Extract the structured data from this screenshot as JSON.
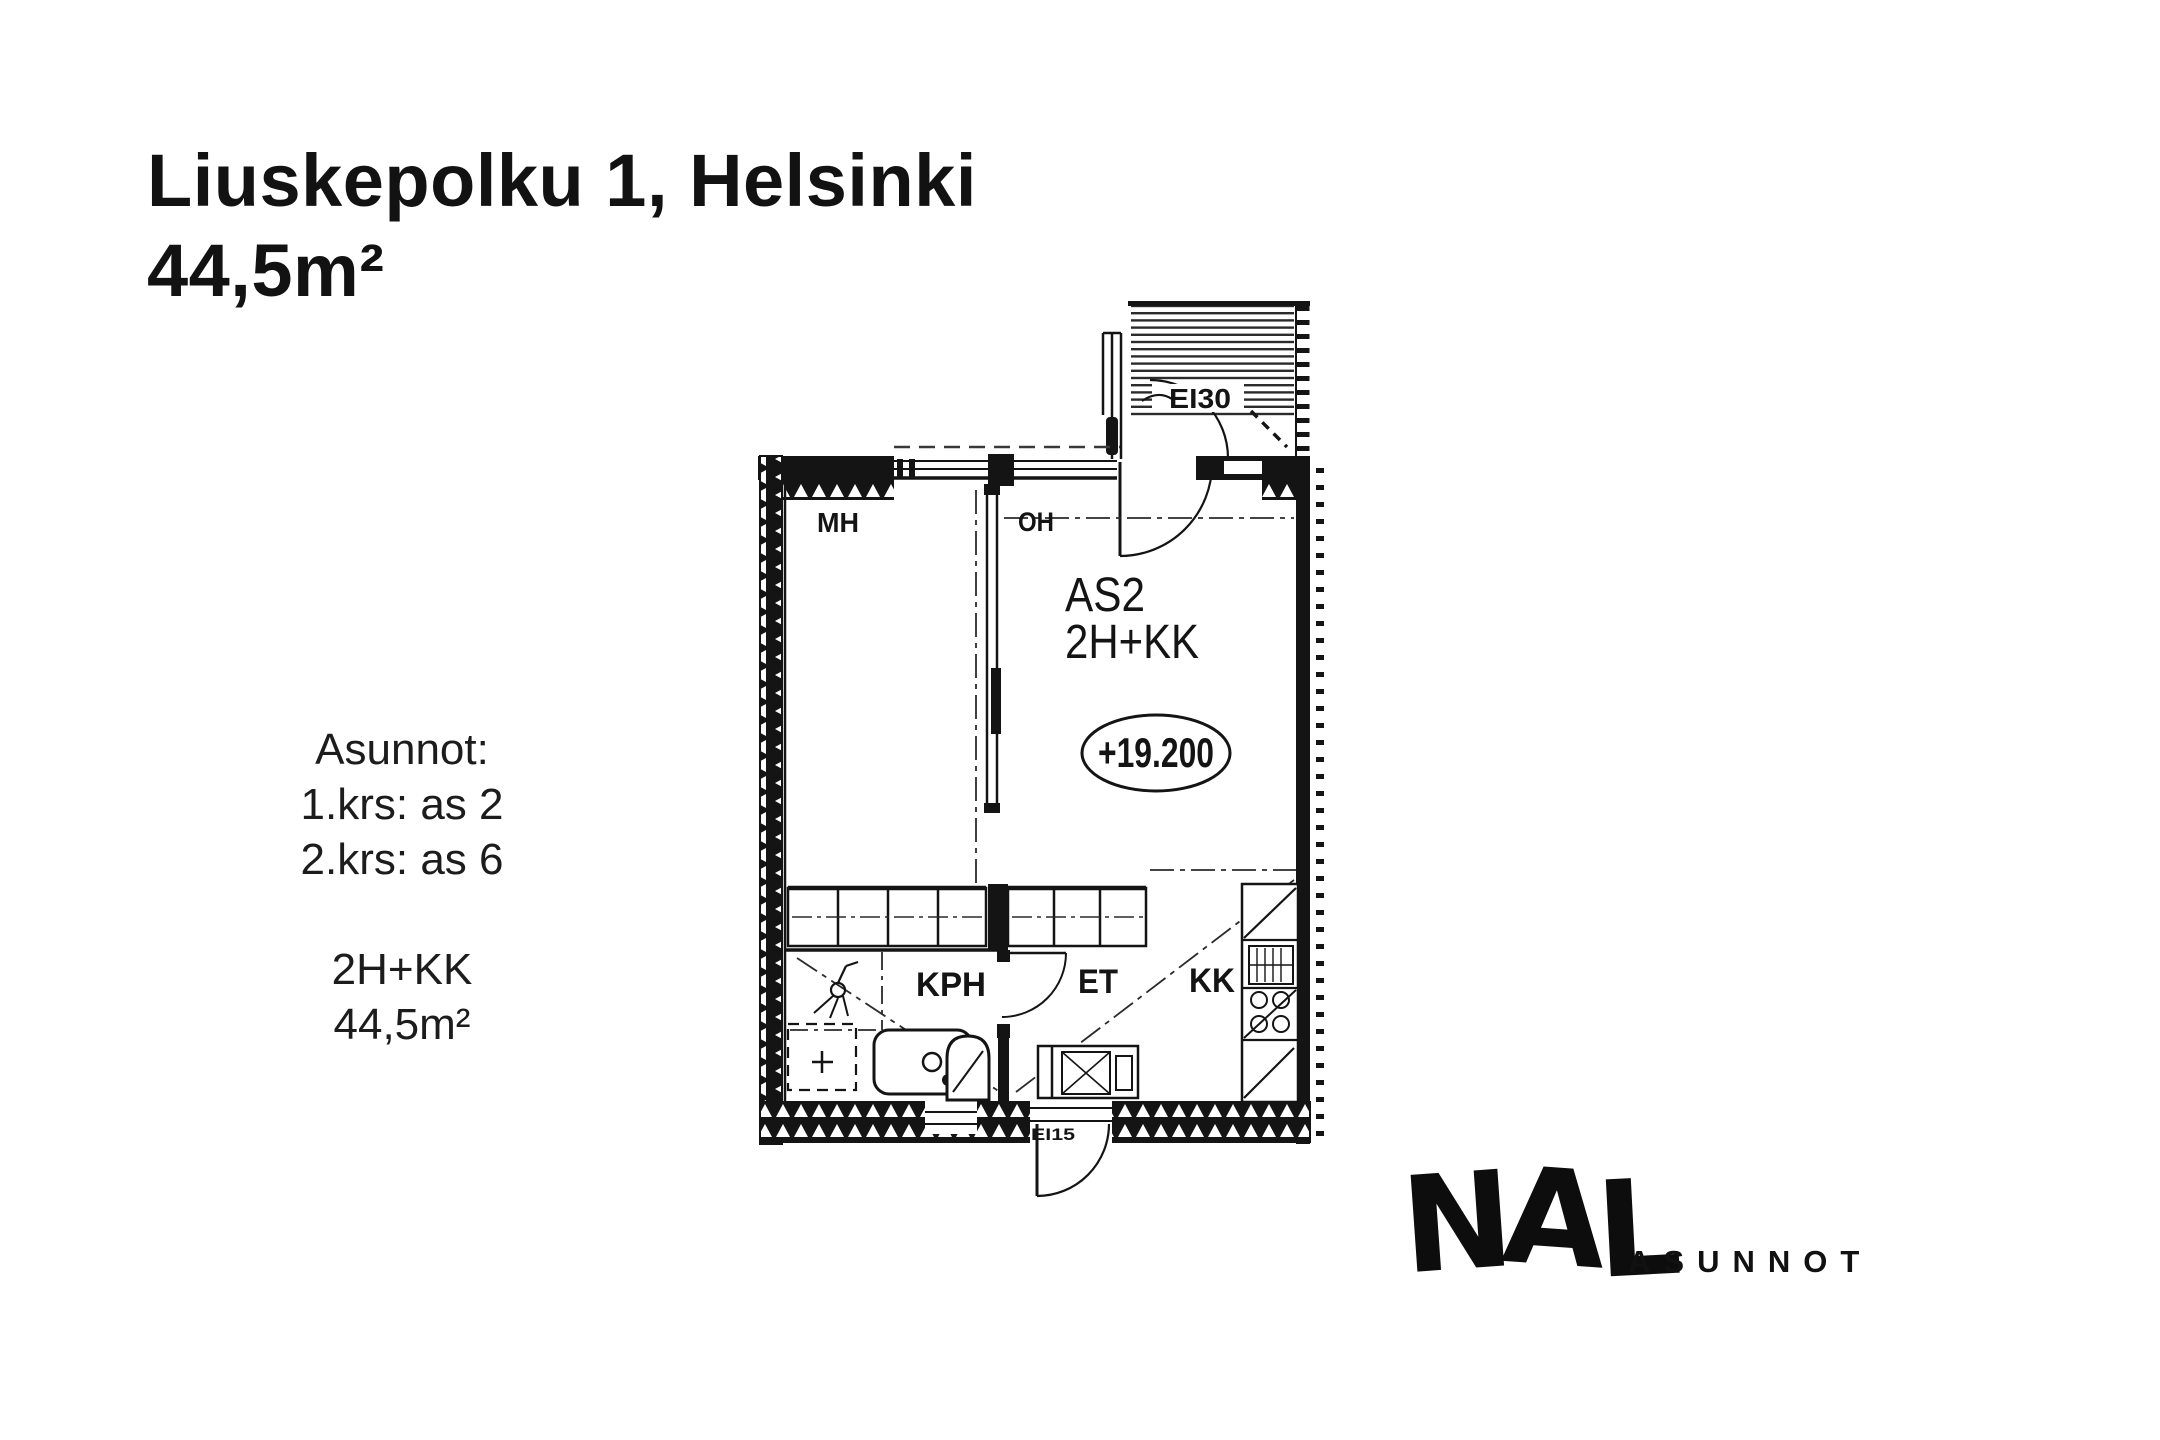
{
  "colors": {
    "background": "#ffffff",
    "ink": "#141414"
  },
  "header": {
    "title": "Liuskepolku 1, Helsinki",
    "area": "44,5m²"
  },
  "info_panel": {
    "lines": [
      "Asunnot:",
      "1.krs: as 2",
      "2.krs: as 6",
      "",
      "2H+KK",
      "44,5m²"
    ]
  },
  "floor_plan": {
    "unit_id": "AS2",
    "unit_type": "2H+KK",
    "elevation": "+19.200",
    "rooms": {
      "bedroom": "MH",
      "living_room": "OH",
      "bathroom": "KPH",
      "hallway": "ET",
      "kitchenette": "KK"
    },
    "fire_ratings": {
      "balcony_door": "EI30",
      "entry_door": "EI15"
    }
  },
  "logo": {
    "letters": [
      "N",
      "A",
      "L"
    ],
    "wordmark": "ASUNNOT"
  }
}
